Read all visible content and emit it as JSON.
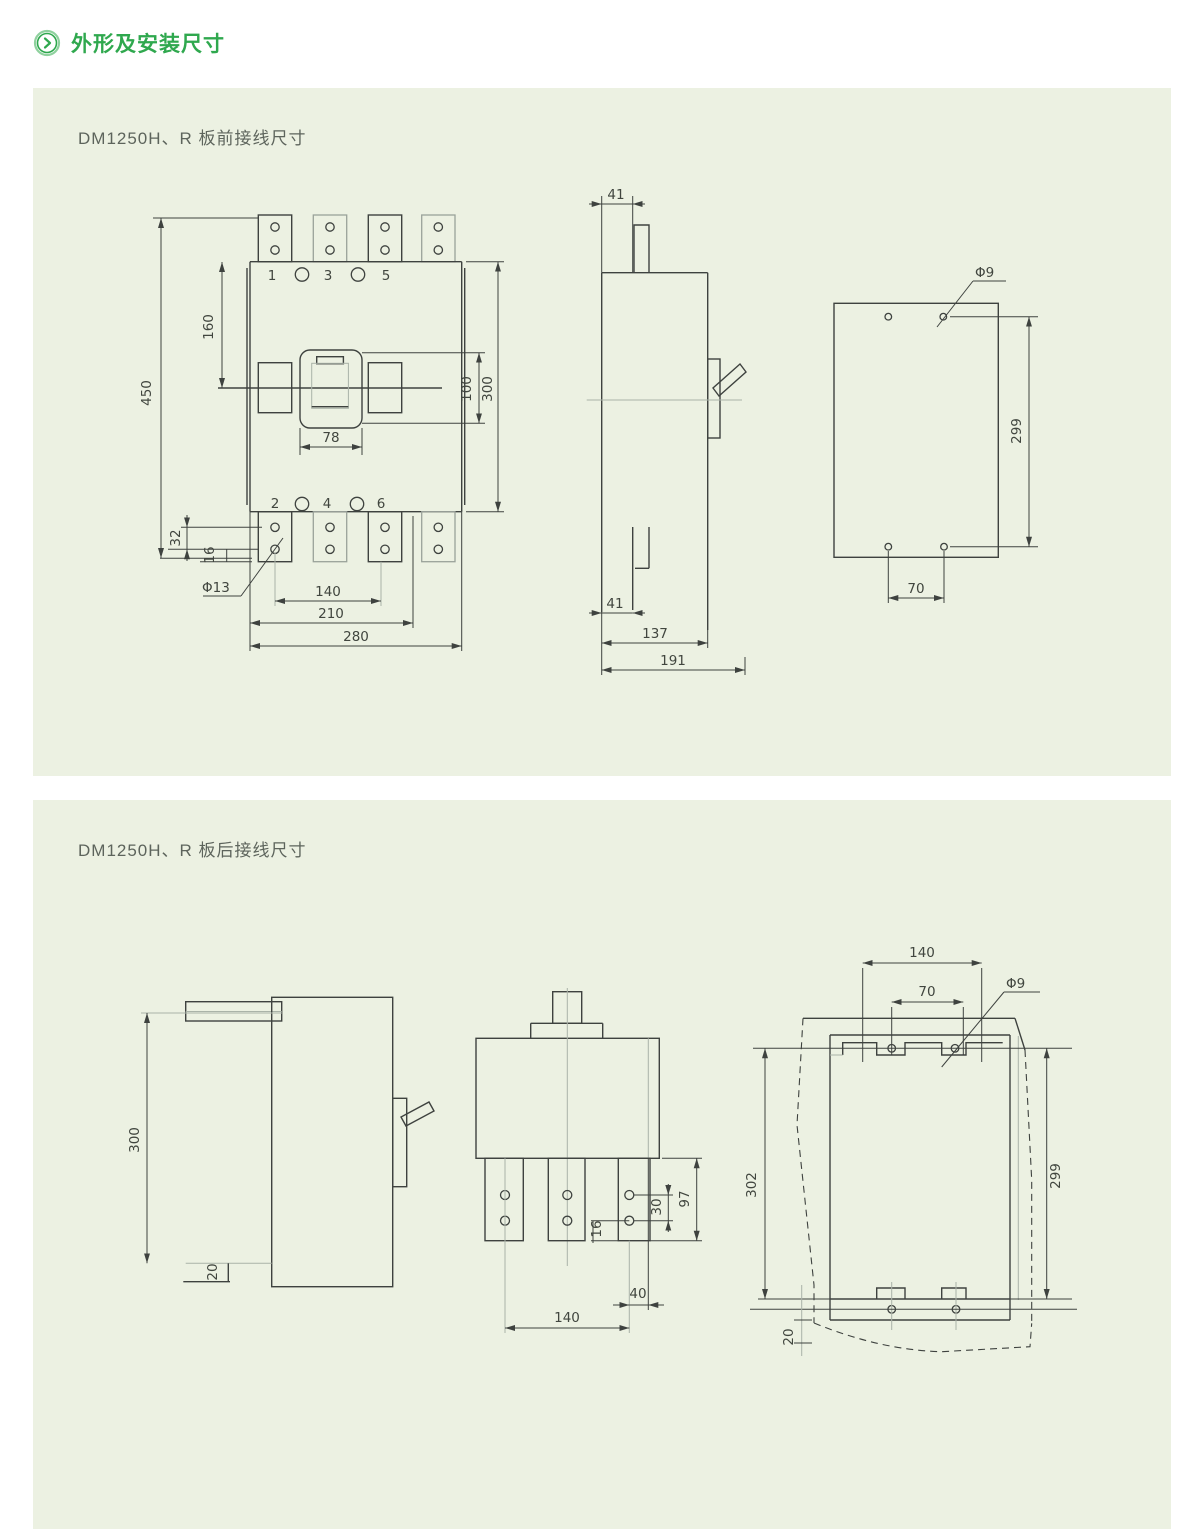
{
  "page": {
    "background": "#ffffff",
    "panel_background": "#ecf1e2",
    "accent_green": "#2fa84e"
  },
  "header": {
    "title": "外形及安装尺寸",
    "icon": "chevron-right-circle-icon"
  },
  "panel_front": {
    "title": "DM1250H、R 板前接线尺寸"
  },
  "panel_rear": {
    "title": "DM1250H、R 板后接线尺寸"
  },
  "front_view": {
    "poles_top": [
      "1",
      "3",
      "5"
    ],
    "poles_bottom": [
      "2",
      "4",
      "6"
    ],
    "d_overall_height": "450",
    "d_top_to_center": "160",
    "d_handle_width": "78",
    "d_cutout_height": "100",
    "d_body_height": "300",
    "d_hole_offset": "32",
    "d_pad_thickness": "16",
    "d_terminal_hole": "Φ13",
    "d_hole_pitch": "140",
    "d_width_mid": "210",
    "d_body_width": "280"
  },
  "side_view": {
    "d_tab_top": "41",
    "d_tab_bottom": "41",
    "d_body_depth": "137",
    "d_overall_depth": "191"
  },
  "mount_view": {
    "d_hole": "Φ9",
    "d_pitch_v": "299",
    "d_pitch_h": "70"
  },
  "rear_side_view": {
    "d_height": "300",
    "d_stud_offset": "20"
  },
  "rear_view": {
    "d_hole_pitch_v": "30",
    "d_strip_length": "97",
    "d_strip_end": "16",
    "d_offset": "40",
    "d_pitch_h": "140"
  },
  "rear_mount_view": {
    "d_width": "140",
    "d_pitch_h": "70",
    "d_hole": "Φ9",
    "d_height_left": "302",
    "d_height_right": "299",
    "d_bottom_gap": "20"
  }
}
